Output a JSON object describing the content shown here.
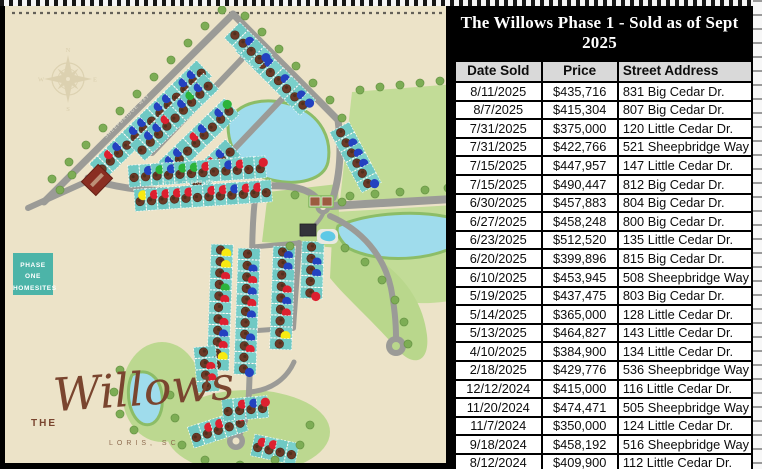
{
  "title": "The Willows Phase 1 - Sold as of Sept 2025",
  "table": {
    "headers": [
      "Date Sold",
      "Price",
      "Street Address"
    ],
    "rows": [
      [
        "8/11/2025",
        "$435,716",
        "831 Big Cedar Dr."
      ],
      [
        "8/7/2025",
        "$415,304",
        "807 Big Cedar Dr."
      ],
      [
        "7/31/2025",
        "$375,000",
        "120 Little Cedar Dr."
      ],
      [
        "7/31/2025",
        "$422,766",
        "521 Sheepbridge Way"
      ],
      [
        "7/15/2025",
        "$447,957",
        "147 Little Cedar Dr."
      ],
      [
        "7/15/2025",
        "$490,447",
        "812 Big Cedar Dr."
      ],
      [
        "6/30/2025",
        "$457,883",
        "804 Big Cedar Dr."
      ],
      [
        "6/27/2025",
        "$458,248",
        "800 Big Cedar Dr."
      ],
      [
        "6/23/2025",
        "$512,520",
        "135 Little Cedar Dr."
      ],
      [
        "6/20/2025",
        "$399,896",
        "815 Big Cedar Dr."
      ],
      [
        "6/10/2025",
        "$453,945",
        "508 Sheepbridge Way"
      ],
      [
        "5/19/2025",
        "$437,475",
        "803 Big Cedar Dr."
      ],
      [
        "5/14/2025",
        "$365,000",
        "128 Little Cedar Dr."
      ],
      [
        "5/13/2025",
        "$464,827",
        "143 Little Cedar Dr."
      ],
      [
        "4/10/2025",
        "$384,900",
        "134 Little Cedar Dr."
      ],
      [
        "2/18/2025",
        "$429,776",
        "536 Sheepbridge Way"
      ],
      [
        "12/12/2024",
        "$415,000",
        "116 Little Cedar Dr."
      ],
      [
        "11/20/2024",
        "$474,471",
        "505 Sheepbridge Way"
      ],
      [
        "11/7/2024",
        "$350,000",
        "124 Little Cedar Dr."
      ],
      [
        "9/18/2024",
        "$458,192",
        "516 Sheepbridge Way"
      ],
      [
        "8/12/2024",
        "$409,900",
        "112 Little Cedar Dr."
      ]
    ]
  },
  "map": {
    "phase_label_lines": [
      "PHASE",
      "ONE",
      "HOMESITES"
    ],
    "logo": {
      "prefix": "THE",
      "name": "Willows",
      "location": "LORIS, SC"
    },
    "compass": [
      "N",
      "E",
      "S",
      "W"
    ],
    "road_labels": [
      {
        "text": "LITTLE CEDAR DR",
        "x": 158,
        "y": 185,
        "angle": -2
      },
      {
        "text": "SHEEPBRIDGE WAY",
        "x": 106,
        "y": 138,
        "angle": -44
      }
    ],
    "colors": {
      "background": "#ece3c8",
      "road": "#9b9b97",
      "lot": "#6fc9c4",
      "lot_alt": "#7ad0cb",
      "pond": "#9fdcec",
      "shore": "#8cbd67",
      "field": "#c2dc97",
      "tree": "#7dad55",
      "sold_tree": "#6b3a27",
      "marker_blue": "#2342c0",
      "marker_red": "#dd2030",
      "marker_green": "#2cb33b",
      "marker_yellow": "#f8ea10",
      "phase_box": "#4cb4a8",
      "logo_brown": "#7a452f",
      "header_gray": "#d9d9d9"
    },
    "lot_strips": [
      {
        "x": 101,
        "y": 168,
        "angle": -44,
        "dots": "orbobbobbobbo"
      },
      {
        "x": 141,
        "y": 149,
        "angle": -44,
        "dots": "obbrobgbo"
      },
      {
        "x": 170,
        "y": 166,
        "angle": -44,
        "dots": "bborbobg"
      },
      {
        "x": 196,
        "y": 183,
        "angle": -44,
        "dots": "obrbo"
      },
      {
        "x": 247,
        "y": 47,
        "angle": 45,
        "dots": "obbobobb"
      },
      {
        "x": 236,
        "y": 34,
        "angle": 45,
        "dots": "obob"
      },
      {
        "x": 342,
        "y": 132,
        "angle": 62,
        "dots": "obbbob"
      },
      {
        "x": 134,
        "y": 176,
        "angle": -4,
        "dots": "obgbggrobror"
      },
      {
        "x": 140,
        "y": 200,
        "angle": -4,
        "dots": "yrrrrorrbrro"
      },
      {
        "x": 222,
        "y": 250,
        "angle": 92,
        "dots": "yyrgrorbryo"
      },
      {
        "x": 249,
        "y": 254,
        "angle": 92,
        "dots": "obrbrbobrob"
      },
      {
        "x": 284,
        "y": 252,
        "angle": 92,
        "dots": "bborbroyo"
      },
      {
        "x": 313,
        "y": 247,
        "angle": 92,
        "dots": "obbor"
      },
      {
        "x": 205,
        "y": 352,
        "angle": 85,
        "dots": "orro"
      },
      {
        "x": 196,
        "y": 436,
        "angle": -18,
        "dots": "orror"
      },
      {
        "x": 258,
        "y": 446,
        "angle": 12,
        "dots": "rroo"
      },
      {
        "x": 228,
        "y": 410,
        "angle": -5,
        "dots": "orbr"
      }
    ]
  }
}
